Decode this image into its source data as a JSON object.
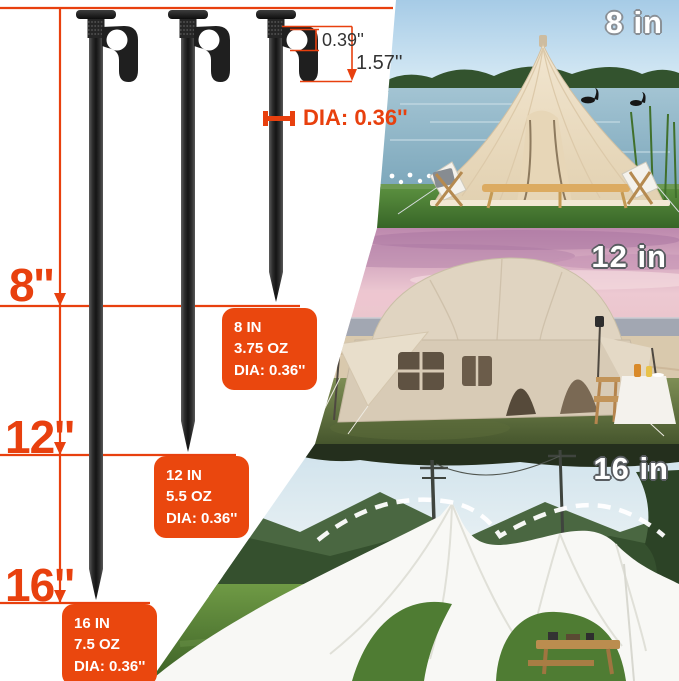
{
  "colors": {
    "dimension_red": "#e8400e",
    "spec_box_orange": "#ea470e",
    "spec_text_white": "#ffffff",
    "detail_dim_text": "#333333"
  },
  "diagram": {
    "left_measurements": [
      "8''",
      "12''",
      "16''"
    ],
    "hook_detail": {
      "hole_diameter": "0.39''",
      "hook_length": "1.57''"
    },
    "shaft_diameter_label": "DIA: 0.36''",
    "spec_boxes": [
      {
        "size": "8 IN",
        "weight": "3.75 OZ",
        "diameter": "DIA: 0.36''"
      },
      {
        "size": "12 IN",
        "weight": "5.5 OZ",
        "diameter": "DIA: 0.36''"
      },
      {
        "size": "16 IN",
        "weight": "7.5 OZ",
        "diameter": "DIA: 0.36''"
      }
    ]
  },
  "photos": [
    {
      "caption": "8 in",
      "description": "beige bell tent on lakeside lawn with camp chairs and black swans"
    },
    {
      "caption": "12 in",
      "description": "large beige cabin tent on beach grass under pink sunset sky"
    },
    {
      "caption": "16 in",
      "description": "white star-shaped canopy tent on green field with mountains"
    }
  ]
}
